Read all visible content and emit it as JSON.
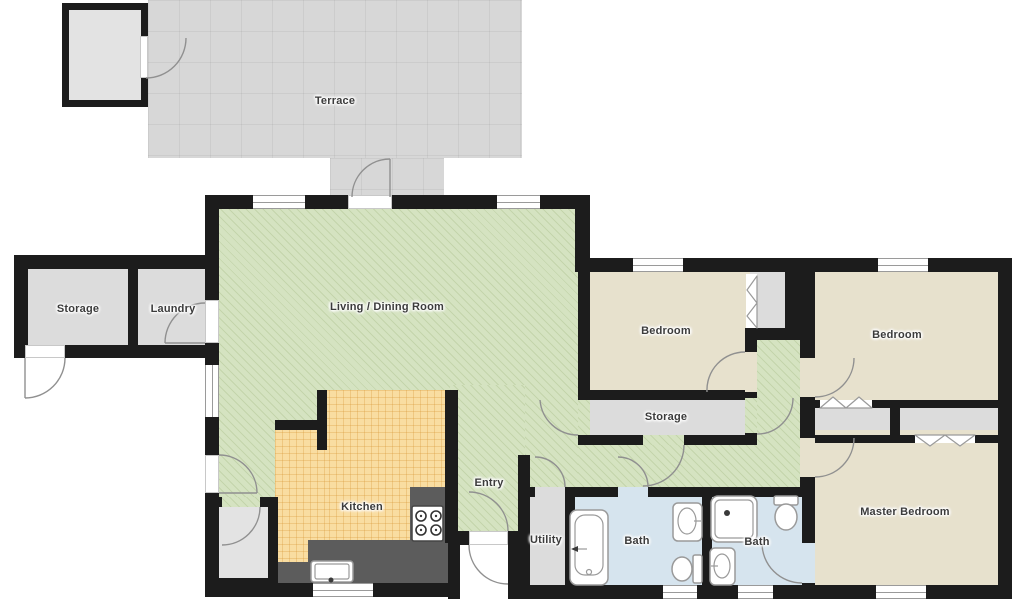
{
  "colors": {
    "bg": "#ffffff",
    "wall": "#1c1c1c",
    "terrace": "#d7d7d7",
    "living": "#d5e3c1",
    "bedroom": "#e7e1cd",
    "bath": "#d6e4ee",
    "gray_room": "#dcdcdc",
    "gray_room_light": "#e3e3e3",
    "kitchen": "#f9dda1",
    "counter": "#5c5c5c",
    "arc": "#909090",
    "fixture_line": "#9a9a9a",
    "window_frame": "#9a9a9a",
    "label_text": "#3b3b3b"
  },
  "rooms": {
    "terrace": {
      "label": "Terrace"
    },
    "storage_left": {
      "label": "Storage"
    },
    "laundry": {
      "label": "Laundry"
    },
    "living": {
      "label": "Living / Dining Room"
    },
    "bedroom_left": {
      "label": "Bedroom"
    },
    "bedroom_right": {
      "label": "Bedroom"
    },
    "storage_mid": {
      "label": "Storage"
    },
    "kitchen": {
      "label": "Kitchen"
    },
    "entry": {
      "label": "Entry"
    },
    "utility": {
      "label": "Utility"
    },
    "bath_left": {
      "label": "Bath"
    },
    "bath_right": {
      "label": "Bath"
    },
    "master": {
      "label": "Master Bedroom"
    }
  },
  "fixtures": [
    "bathtub",
    "shower",
    "toilet",
    "washbasin",
    "kitchen-sink",
    "stove",
    "door-swing",
    "window",
    "sliding-closet-door"
  ]
}
